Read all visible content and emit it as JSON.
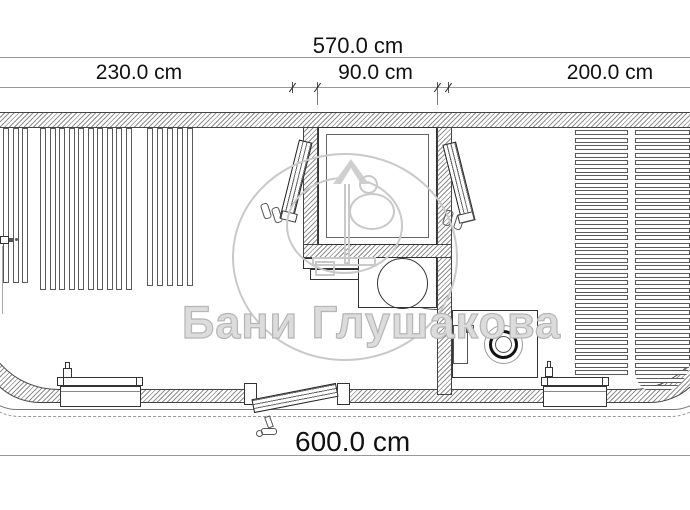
{
  "dimensions": {
    "top_total": "570.0 cm",
    "segments": [
      {
        "label": "230.0 cm"
      },
      {
        "label": "90.0 cm"
      },
      {
        "label": "200.0 cm"
      }
    ],
    "bottom_total": "600.0 cm"
  },
  "watermark": {
    "text": "Бани Глушакова"
  },
  "colors": {
    "drawing_line": "#333333",
    "dimension_line": "#999999",
    "wall_hatch": "#8f8f8f",
    "watermark": "#c9c9c9"
  },
  "decking": {
    "groups": [
      {
        "name": "left-room-wall-slats-1",
        "x": 3,
        "y": 128,
        "len": 155,
        "count": 3,
        "pitch": 9.7,
        "slat": 6,
        "dir": "v"
      },
      {
        "name": "left-room-wall-slats-2",
        "x": 40,
        "y": 128,
        "len": 162,
        "count": 10,
        "pitch": 9.5,
        "slat": 6,
        "dir": "v"
      },
      {
        "name": "left-room-wall-slats-3",
        "x": 147,
        "y": 128,
        "len": 158,
        "count": 5,
        "pitch": 10,
        "slat": 6,
        "dir": "v"
      },
      {
        "name": "lounger-deck-left",
        "x": 575,
        "y": 130,
        "len": 53,
        "count": 33,
        "pitch": 7.5,
        "slat": 5,
        "dir": "h"
      },
      {
        "name": "lounger-deck-right",
        "x": 635,
        "y": 130,
        "len": 55,
        "count": 35,
        "pitch": 7.5,
        "slat": 5,
        "dir": "h",
        "clip": "0 0 46px 30px"
      }
    ]
  }
}
